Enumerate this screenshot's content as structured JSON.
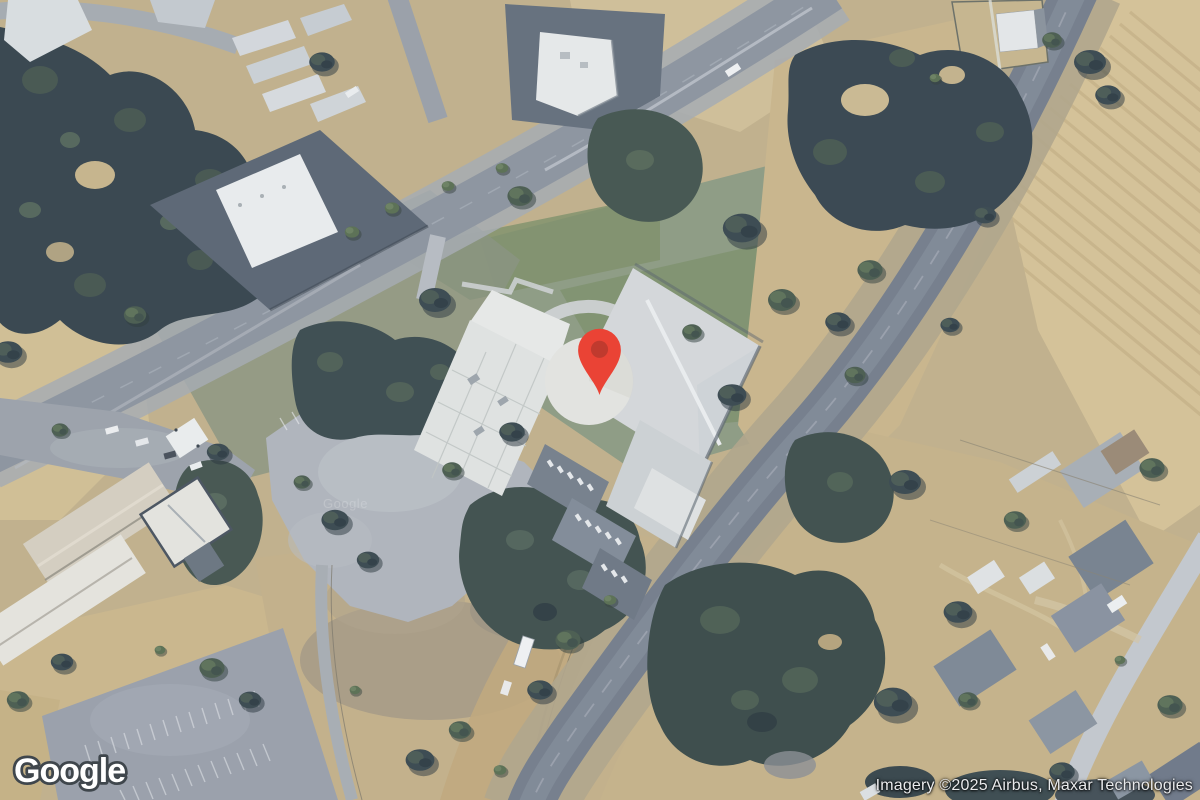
{
  "map": {
    "view": "satellite",
    "marker": {
      "color": "#EA4335",
      "inner_color": "#C03A2E"
    }
  },
  "branding": {
    "logo_text": "Google"
  },
  "watermark": {
    "text": "Google"
  },
  "attribution": {
    "text": "Imagery ©2025 Airbus, Maxar Technologies"
  }
}
